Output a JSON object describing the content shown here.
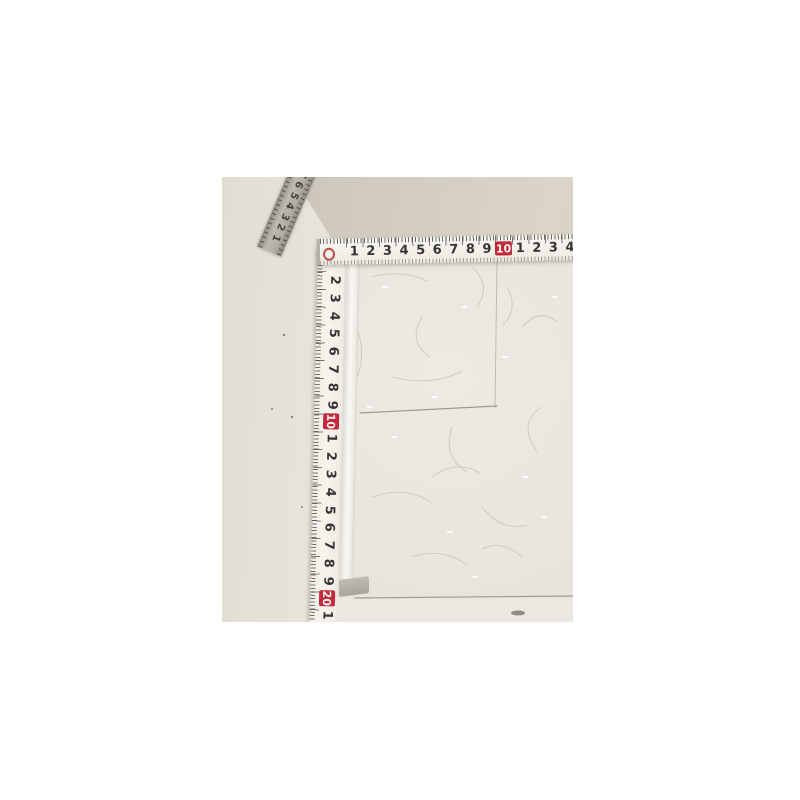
{
  "photo": {
    "description": "Corner of a light box interior measured by folding tape rules",
    "horizontal_ruler": {
      "numbers": [
        "1",
        "2",
        "3",
        "4",
        "5",
        "6",
        "7",
        "8",
        "9",
        "10",
        "1",
        "2",
        "3",
        "4"
      ],
      "highlight": "10",
      "highlight_color": "#c2293e",
      "zero_mark_color": "#c44b4b"
    },
    "vertical_ruler": {
      "numbers": [
        "2",
        "3",
        "4",
        "5",
        "6",
        "7",
        "8",
        "9",
        "10",
        "1",
        "2",
        "3",
        "4",
        "5",
        "6",
        "7",
        "8",
        "9",
        "20",
        "1"
      ],
      "highlights": [
        "10",
        "20"
      ],
      "highlight_color": "#c2293e"
    },
    "diagonal_ruler": {
      "numbers": [
        "1",
        "2",
        "3",
        "4",
        "5",
        "6",
        "7"
      ]
    },
    "colors": {
      "tape_ivory": "#f3f1ea",
      "diagonal_tape_gray": "#b2ada4",
      "ceiling": "#d2ccc1",
      "left_wall": "#e9e4da",
      "panel": "#e9e6df",
      "aluminium_strip": "#f9f8f4",
      "page_background": "#ffffff"
    }
  }
}
